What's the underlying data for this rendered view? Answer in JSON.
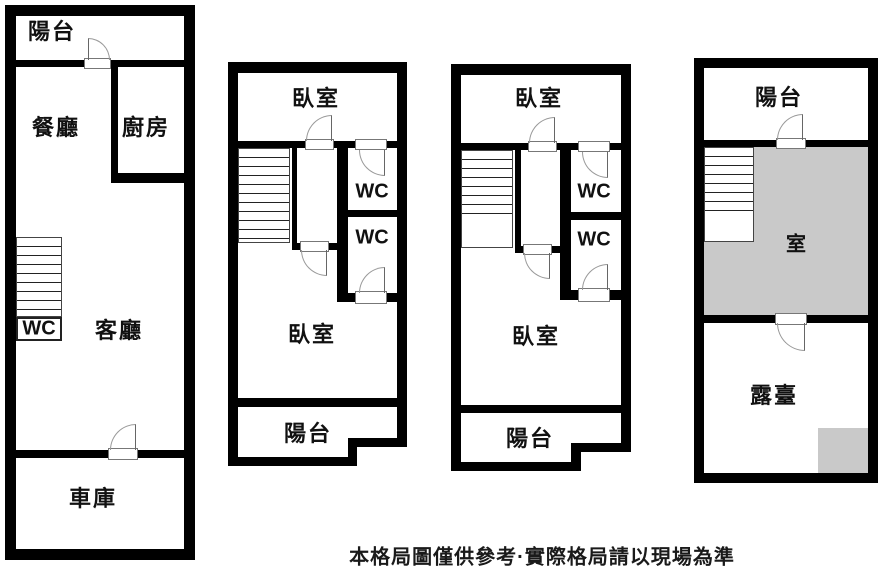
{
  "plan1": {
    "balcony": "陽台",
    "dining": "餐廳",
    "kitchen": "廚房",
    "living": "客廳",
    "wc": "WC",
    "garage": "車庫"
  },
  "plan2": {
    "bedroom_top": "臥室",
    "wc_top": "WC",
    "wc_bottom": "WC",
    "bedroom_bottom": "臥室",
    "balcony": "陽台"
  },
  "plan3": {
    "bedroom_top": "臥室",
    "wc_top": "WC",
    "wc_bottom": "WC",
    "bedroom_bottom": "臥室",
    "balcony": "陽台"
  },
  "plan4": {
    "balcony": "陽台",
    "room": "室",
    "terrace": "露臺"
  },
  "disclaimer": "本格局圖僅供參考·實際格局請以現場為準",
  "colors": {
    "wall": "#000000",
    "shaded_area": "#c9c9c9",
    "background": "#ffffff"
  }
}
